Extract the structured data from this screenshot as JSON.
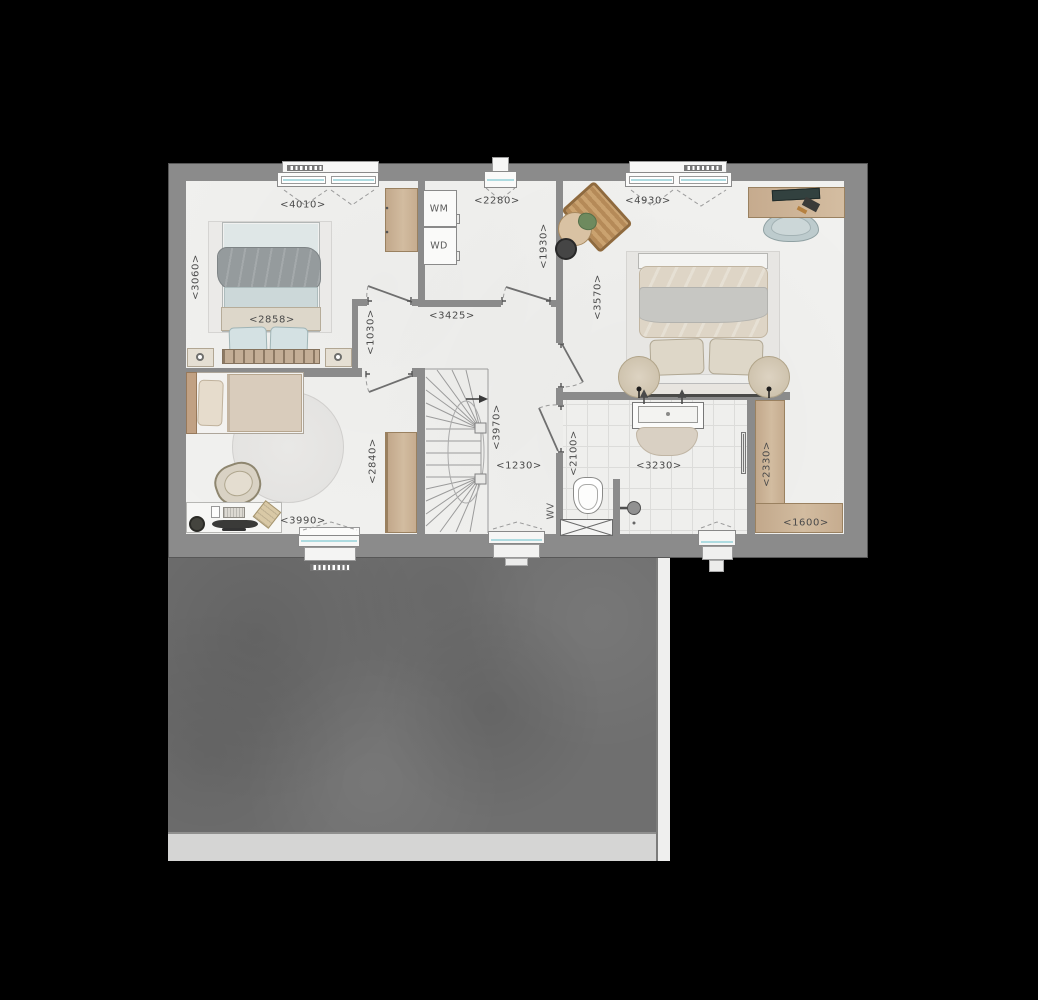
{
  "meta": {
    "type": "architectural-floor-plan",
    "view": "top-down upper floor with roof below"
  },
  "colors": {
    "background": "#000000",
    "wall": "#8b8b8b",
    "wall_outline": "#575757",
    "floor": "#f1f1ef",
    "wood": "#c9b299",
    "glazing": "#aedbe0",
    "roof": "#6f6f6f",
    "gutter": "#d5d5d4",
    "fascia": "#efefee",
    "label_text": "#4a4a4a"
  },
  "appliances": {
    "washing_machine": "WM",
    "dryer": "WD",
    "wv": "WV"
  },
  "labels": [
    {
      "name": "dim-bedroom1-width",
      "text": "<4010>",
      "x": 303,
      "y": 205,
      "rot": 0
    },
    {
      "name": "dim-bedroom1-depth",
      "text": "<3060>",
      "x": 196,
      "y": 277,
      "rot": -90
    },
    {
      "name": "dim-bedroom1-bed",
      "text": "<2858>",
      "x": 272,
      "y": 320,
      "rot": 0
    },
    {
      "name": "dim-closet-width",
      "text": "<2280>",
      "x": 497,
      "y": 201,
      "rot": 0
    },
    {
      "name": "dim-closet-depth",
      "text": "<1930>",
      "x": 544,
      "y": 246,
      "rot": -90
    },
    {
      "name": "dim-bedroom2-width",
      "text": "<4930>",
      "x": 648,
      "y": 201,
      "rot": 0
    },
    {
      "name": "dim-bedroom2-depth",
      "text": "<3570>",
      "x": 598,
      "y": 297,
      "rot": -90
    },
    {
      "name": "dim-hall-width",
      "text": "<3425>",
      "x": 452,
      "y": 316,
      "rot": 0
    },
    {
      "name": "dim-doorway-nook",
      "text": "<1030>",
      "x": 371,
      "y": 332,
      "rot": -90
    },
    {
      "name": "dim-bedroom3-wardrobe",
      "text": "<2840>",
      "x": 373,
      "y": 461,
      "rot": -90
    },
    {
      "name": "dim-stairs",
      "text": "<3970>",
      "x": 497,
      "y": 427,
      "rot": -90
    },
    {
      "name": "dim-landing",
      "text": "<1230>",
      "x": 519,
      "y": 466,
      "rot": 0
    },
    {
      "name": "dim-bathroom-depth",
      "text": "<2100>",
      "x": 574,
      "y": 453,
      "rot": -90
    },
    {
      "name": "dim-bathroom-width",
      "text": "<3230>",
      "x": 659,
      "y": 466,
      "rot": 0
    },
    {
      "name": "dim-walkin-depth",
      "text": "<2330>",
      "x": 767,
      "y": 464,
      "rot": -90
    },
    {
      "name": "dim-walkin-width",
      "text": "<1600>",
      "x": 806,
      "y": 523,
      "rot": 0
    },
    {
      "name": "dim-bedroom3-width",
      "text": "<3990>",
      "x": 303,
      "y": 521,
      "rot": 0
    },
    {
      "name": "label-washing-machine",
      "text": "WM",
      "x": 439,
      "y": 209,
      "rot": 0
    },
    {
      "name": "label-dryer",
      "text": "WD",
      "x": 439,
      "y": 246,
      "rot": 0
    },
    {
      "name": "label-wv",
      "text": "WV",
      "x": 551,
      "y": 511,
      "rot": -90
    }
  ]
}
